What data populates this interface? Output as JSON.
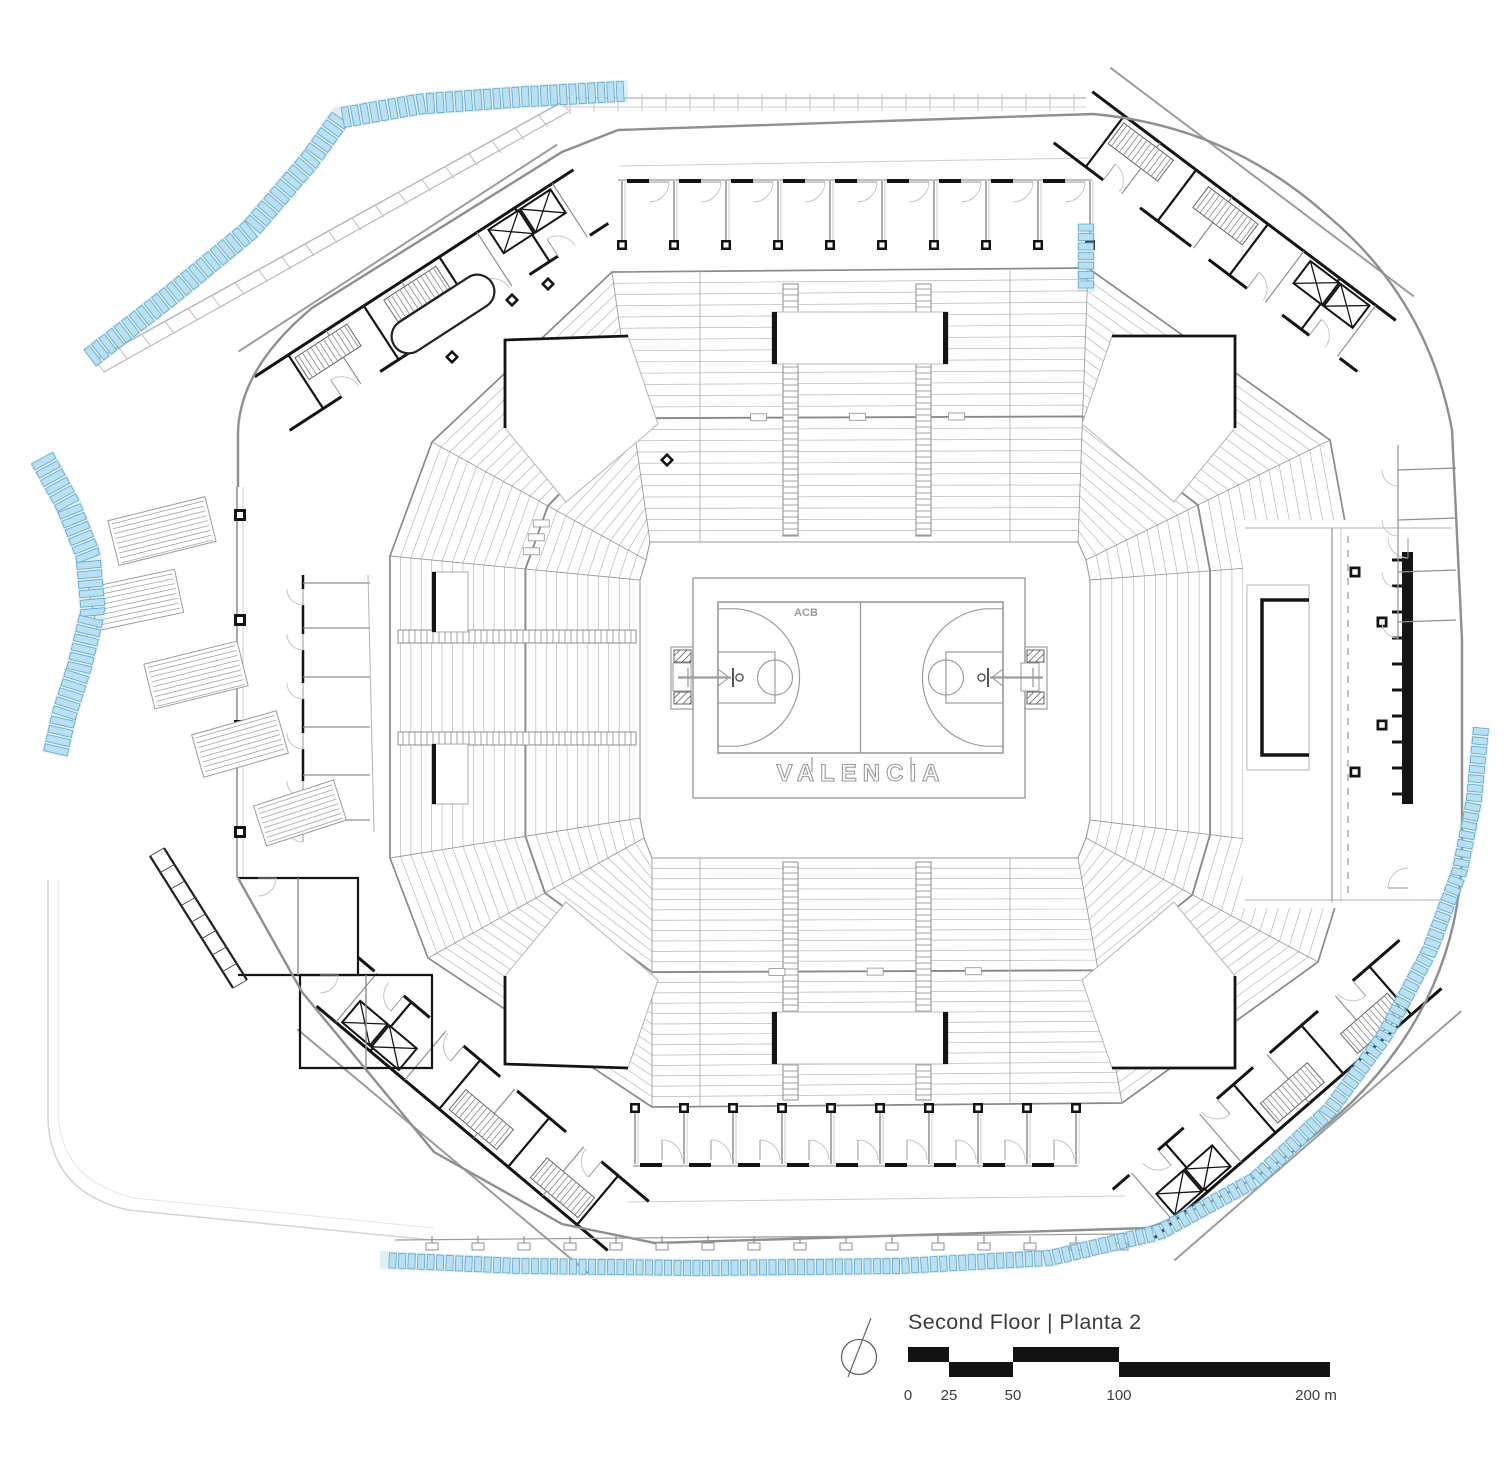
{
  "title_block": {
    "title": "Second Floor | Planta 2",
    "scale_labels": [
      "0",
      "25",
      "50",
      "100",
      "200 m"
    ],
    "scale_unit": "m"
  },
  "court": {
    "arena_label": "VALENCIA",
    "court_label": "ACB"
  },
  "colors": {
    "canopy_blue_fill": "#b9e0f2",
    "canopy_blue_stroke": "#61a7c9",
    "wall_black": "#141414",
    "wall_gray": "#8f8f8f",
    "seat_row_gray": "#b8b8b8",
    "tier_gray": "#8a8a8a",
    "light_gray": "#cdcdcd",
    "court_line_gray": "#9c9c9c",
    "label_gray": "#9b9b9b",
    "text_dark": "#3b3b3b",
    "scale_black": "#121212"
  }
}
